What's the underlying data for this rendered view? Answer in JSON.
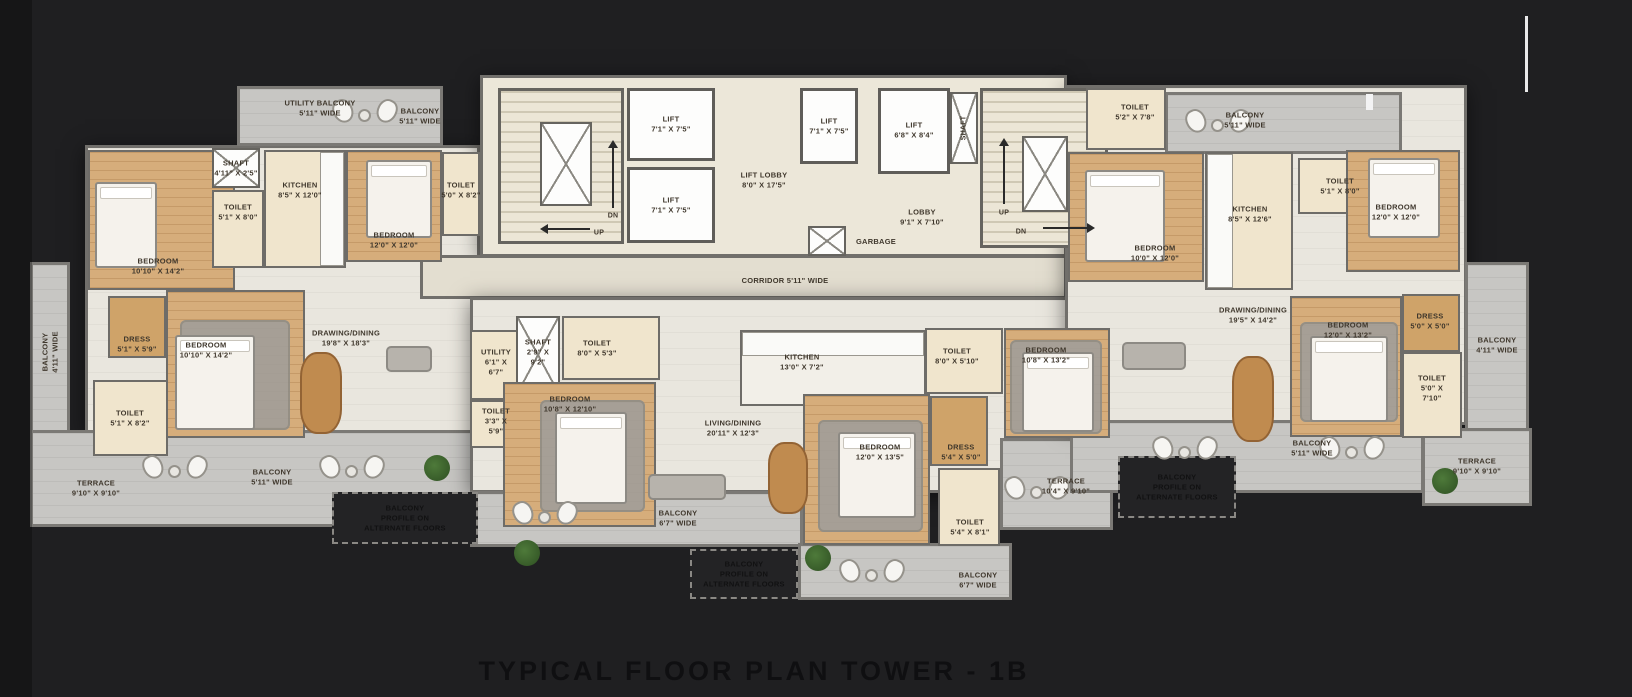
{
  "title": "TYPICAL FLOOR PLAN TOWER - 1B",
  "colors": {
    "background": "#1f1f21",
    "wall": "#6e6c68",
    "floor_light": "#e9e6de",
    "core_floor": "#ece7d9",
    "balcony_floor": "#c7c6c3",
    "wood_floor": "#d6ad7b",
    "cream_floor": "#f0e5cd",
    "lift_white": "#fdfdfc",
    "dashed_region": "#232325",
    "title_color": "#0f0f11"
  },
  "floorplan": {
    "labels": [
      {
        "id": "utility-balcony-top",
        "lines": [
          "UTILITY BALCONY",
          "5'11\" WIDE"
        ]
      },
      {
        "id": "balcony-top-left",
        "lines": [
          "BALCONY",
          "5'11\" WIDE"
        ]
      },
      {
        "id": "shaft-left",
        "lines": [
          "SHAFT",
          "4'11\" X 2'5\""
        ]
      },
      {
        "id": "toilet-left-1",
        "lines": [
          "TOILET",
          "5'1\" X 8'0\""
        ]
      },
      {
        "id": "kitchen-left",
        "lines": [
          "KITCHEN",
          "8'5\" X 12'0\""
        ]
      },
      {
        "id": "bedroom-left-2",
        "lines": [
          "BEDROOM",
          "12'0\" X 12'0\""
        ]
      },
      {
        "id": "toilet-left-2",
        "lines": [
          "TOILET",
          "5'0\" X 8'2\""
        ]
      },
      {
        "id": "bedroom-top-left",
        "lines": [
          "BEDROOM",
          "10'10\" X 14'2\""
        ]
      },
      {
        "id": "dress-left",
        "lines": [
          "DRESS",
          "5'1\" X 5'9\""
        ]
      },
      {
        "id": "bedroom-left-3",
        "lines": [
          "BEDROOM",
          "10'10\" X 14'2\""
        ]
      },
      {
        "id": "toilet-left-3",
        "lines": [
          "TOILET",
          "5'1\" X 8'2\""
        ]
      },
      {
        "id": "drawing-dining-left",
        "lines": [
          "DRAWING/DINING",
          "19'8\" X 18'3\""
        ]
      },
      {
        "id": "balcony-left-vert",
        "lines": [
          "BALCONY",
          "4'11\" WIDE"
        ]
      },
      {
        "id": "terrace-left",
        "lines": [
          "TERRACE",
          "9'10\" X 9'10\""
        ]
      },
      {
        "id": "balcony-bottom-left",
        "lines": [
          "BALCONY",
          "5'11\" WIDE"
        ]
      },
      {
        "id": "balcony-profile-left",
        "lines": [
          "BALCONY",
          "PROFILE ON",
          "ALTERNATE FLOORS"
        ]
      },
      {
        "id": "utility-room",
        "lines": [
          "UTILITY",
          "6'1\" X",
          "6'7\""
        ]
      },
      {
        "id": "lift-1",
        "lines": [
          "LIFT",
          "7'1\" X 7'5\""
        ]
      },
      {
        "id": "lift-2",
        "lines": [
          "LIFT",
          "7'1\" X 7'5\""
        ]
      },
      {
        "id": "lift-3",
        "lines": [
          "LIFT",
          "7'1\" X 7'5\""
        ]
      },
      {
        "id": "lift-4",
        "lines": [
          "LIFT",
          "6'8\" X 8'4\""
        ]
      },
      {
        "id": "lift-lobby",
        "lines": [
          "LIFT LOBBY",
          "8'0\" X 17'5\""
        ]
      },
      {
        "id": "lobby",
        "lines": [
          "LOBBY",
          "9'1\" X 7'10\""
        ]
      },
      {
        "id": "garbage",
        "lines": [
          "GARBAGE"
        ]
      },
      {
        "id": "corridor",
        "lines": [
          "CORRIDOR 5'11\" WIDE"
        ]
      },
      {
        "id": "shaft-core",
        "lines": [
          "SHAFT"
        ]
      },
      {
        "id": "up-left",
        "lines": [
          "UP"
        ]
      },
      {
        "id": "dn-left",
        "lines": [
          "DN"
        ]
      },
      {
        "id": "up-right",
        "lines": [
          "UP"
        ]
      },
      {
        "id": "dn-right",
        "lines": [
          "DN"
        ]
      },
      {
        "id": "shaft-center",
        "lines": [
          "SHAFT",
          "2'9\" X",
          "9'2\""
        ]
      },
      {
        "id": "toilet-center-1",
        "lines": [
          "TOILET",
          "8'0\" X 5'3\""
        ]
      },
      {
        "id": "toilet-center-small",
        "lines": [
          "TOILET",
          "3'3\" X",
          "5'9\""
        ]
      },
      {
        "id": "bedroom-center-1",
        "lines": [
          "BEDROOM",
          "10'8\" X 12'10\""
        ]
      },
      {
        "id": "kitchen-center",
        "lines": [
          "KITCHEN",
          "13'0\" X 7'2\""
        ]
      },
      {
        "id": "living-dining",
        "lines": [
          "LIVING/DINING",
          "20'11\" X 12'3\""
        ]
      },
      {
        "id": "bedroom-center-2",
        "lines": [
          "BEDROOM",
          "12'0\" X 13'5\""
        ]
      },
      {
        "id": "dress-center",
        "lines": [
          "DRESS",
          "5'4\" X 5'0\""
        ]
      },
      {
        "id": "toilet-center-2",
        "lines": [
          "TOILET",
          "5'4\" X 8'1\""
        ]
      },
      {
        "id": "balcony-center-1",
        "lines": [
          "BALCONY",
          "6'7\" WIDE"
        ]
      },
      {
        "id": "balcony-center-2",
        "lines": [
          "BALCONY",
          "6'7\" WIDE"
        ]
      },
      {
        "id": "balcony-profile-center",
        "lines": [
          "BALCONY",
          "PROFILE ON",
          "ALTERNATE FLOORS"
        ]
      },
      {
        "id": "toilet-midright-top",
        "lines": [
          "TOILET",
          "5'2\" X 7'8\""
        ]
      },
      {
        "id": "bedroom-right-1",
        "lines": [
          "BEDROOM",
          "10'0\" X 12'0\""
        ]
      },
      {
        "id": "toilet-midright",
        "lines": [
          "TOILET",
          "8'0\" X 5'10\""
        ]
      },
      {
        "id": "bedroom-midright",
        "lines": [
          "BEDROOM",
          "10'8\" X 13'2\""
        ]
      },
      {
        "id": "terrace-center",
        "lines": [
          "TERRACE",
          "10'4\" X 9'10\""
        ]
      },
      {
        "id": "balcony-top-right",
        "lines": [
          "BALCONY",
          "5'11\" WIDE"
        ]
      },
      {
        "id": "kitchen-right",
        "lines": [
          "KITCHEN",
          "8'5\" X 12'6\""
        ]
      },
      {
        "id": "toilet-right-1",
        "lines": [
          "TOILET",
          "5'1\" X 8'0\""
        ]
      },
      {
        "id": "bedroom-right-2",
        "lines": [
          "BEDROOM",
          "12'0\" X 12'0\""
        ]
      },
      {
        "id": "drawing-dining-right",
        "lines": [
          "DRAWING/DINING",
          "19'5\" X 14'2\""
        ]
      },
      {
        "id": "bedroom-right-3",
        "lines": [
          "BEDROOM",
          "12'0\" X 13'2\""
        ]
      },
      {
        "id": "dress-right",
        "lines": [
          "DRESS",
          "5'0\" X 5'0\""
        ]
      },
      {
        "id": "toilet-right-3",
        "lines": [
          "TOILET",
          "5'0\" X",
          "7'10\""
        ]
      },
      {
        "id": "balcony-right-vert",
        "lines": [
          "BALCONY",
          "4'11\" WIDE"
        ]
      },
      {
        "id": "balcony-bottom-right",
        "lines": [
          "BALCONY",
          "5'11\" WIDE"
        ]
      },
      {
        "id": "terrace-right",
        "lines": [
          "TERRACE",
          "9'10\" X 9'10\""
        ]
      },
      {
        "id": "balcony-profile-right",
        "lines": [
          "BALCONY",
          "PROFILE ON",
          "ALTERNATE FLOORS"
        ]
      }
    ]
  }
}
